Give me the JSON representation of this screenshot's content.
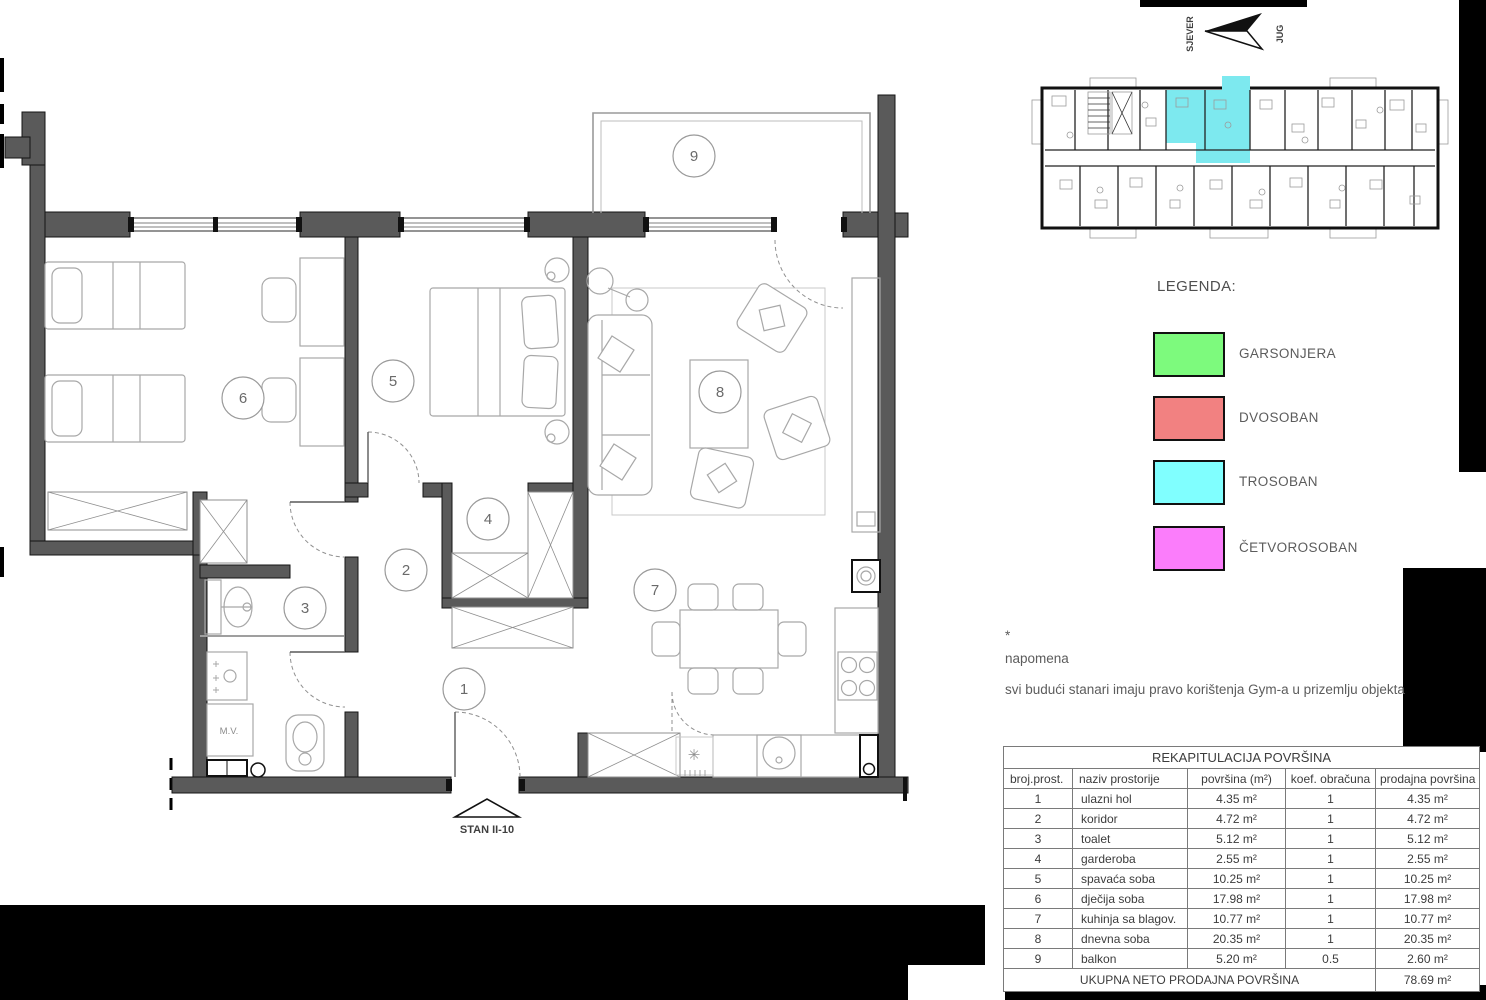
{
  "north_indicator": {
    "north": "SJEVER",
    "south": "JUG"
  },
  "legend": {
    "title": "LEGENDA:",
    "items": [
      {
        "label": "GARSONJERA",
        "color": "#7dfa7d"
      },
      {
        "label": "DVOSOBAN",
        "color": "#f28181"
      },
      {
        "label": "TROSOBAN",
        "color": "#80ffff"
      },
      {
        "label": "ČETVOROSOBAN",
        "color": "#fb7dfb"
      }
    ]
  },
  "overview": {
    "highlight_color": "#7de9ef"
  },
  "note": {
    "star": "*",
    "heading": "napomena",
    "text": "svi budući stanari imaju pravo korištenja Gym-a u prizemlju objekta"
  },
  "floorplan": {
    "apartment_label": "STAN II-10",
    "washing_machine_label": "M.V.",
    "kitchen_symbol": "✳",
    "room_numbers": [
      "1",
      "2",
      "3",
      "4",
      "5",
      "6",
      "7",
      "8",
      "9"
    ]
  },
  "table": {
    "title": "REKAPITULACIJA POVRŠINA",
    "columns": [
      "broj.prost.",
      "naziv prostorije",
      "površina (m²)",
      "koef. obračuna",
      "prodajna površina"
    ],
    "rows": [
      [
        "1",
        "ulazni hol",
        "4.35 m²",
        "1",
        "4.35 m²"
      ],
      [
        "2",
        "koridor",
        "4.72 m²",
        "1",
        "4.72 m²"
      ],
      [
        "3",
        "toalet",
        "5.12 m²",
        "1",
        "5.12 m²"
      ],
      [
        "4",
        "garderoba",
        "2.55 m²",
        "1",
        "2.55 m²"
      ],
      [
        "5",
        "spavaća soba",
        "10.25 m²",
        "1",
        "10.25 m²"
      ],
      [
        "6",
        "dječija soba",
        "17.98 m²",
        "1",
        "17.98 m²"
      ],
      [
        "7",
        "kuhinja sa blagov.",
        "10.77 m²",
        "1",
        "10.77 m²"
      ],
      [
        "8",
        "dnevna soba",
        "20.35 m²",
        "1",
        "20.35 m²"
      ],
      [
        "9",
        "balkon",
        "5.20 m²",
        "0.5",
        "2.60 m²"
      ]
    ],
    "footer": {
      "label": "UKUPNA NETO PRODAJNA POVRŠINA",
      "value": "78.69 m²"
    }
  }
}
